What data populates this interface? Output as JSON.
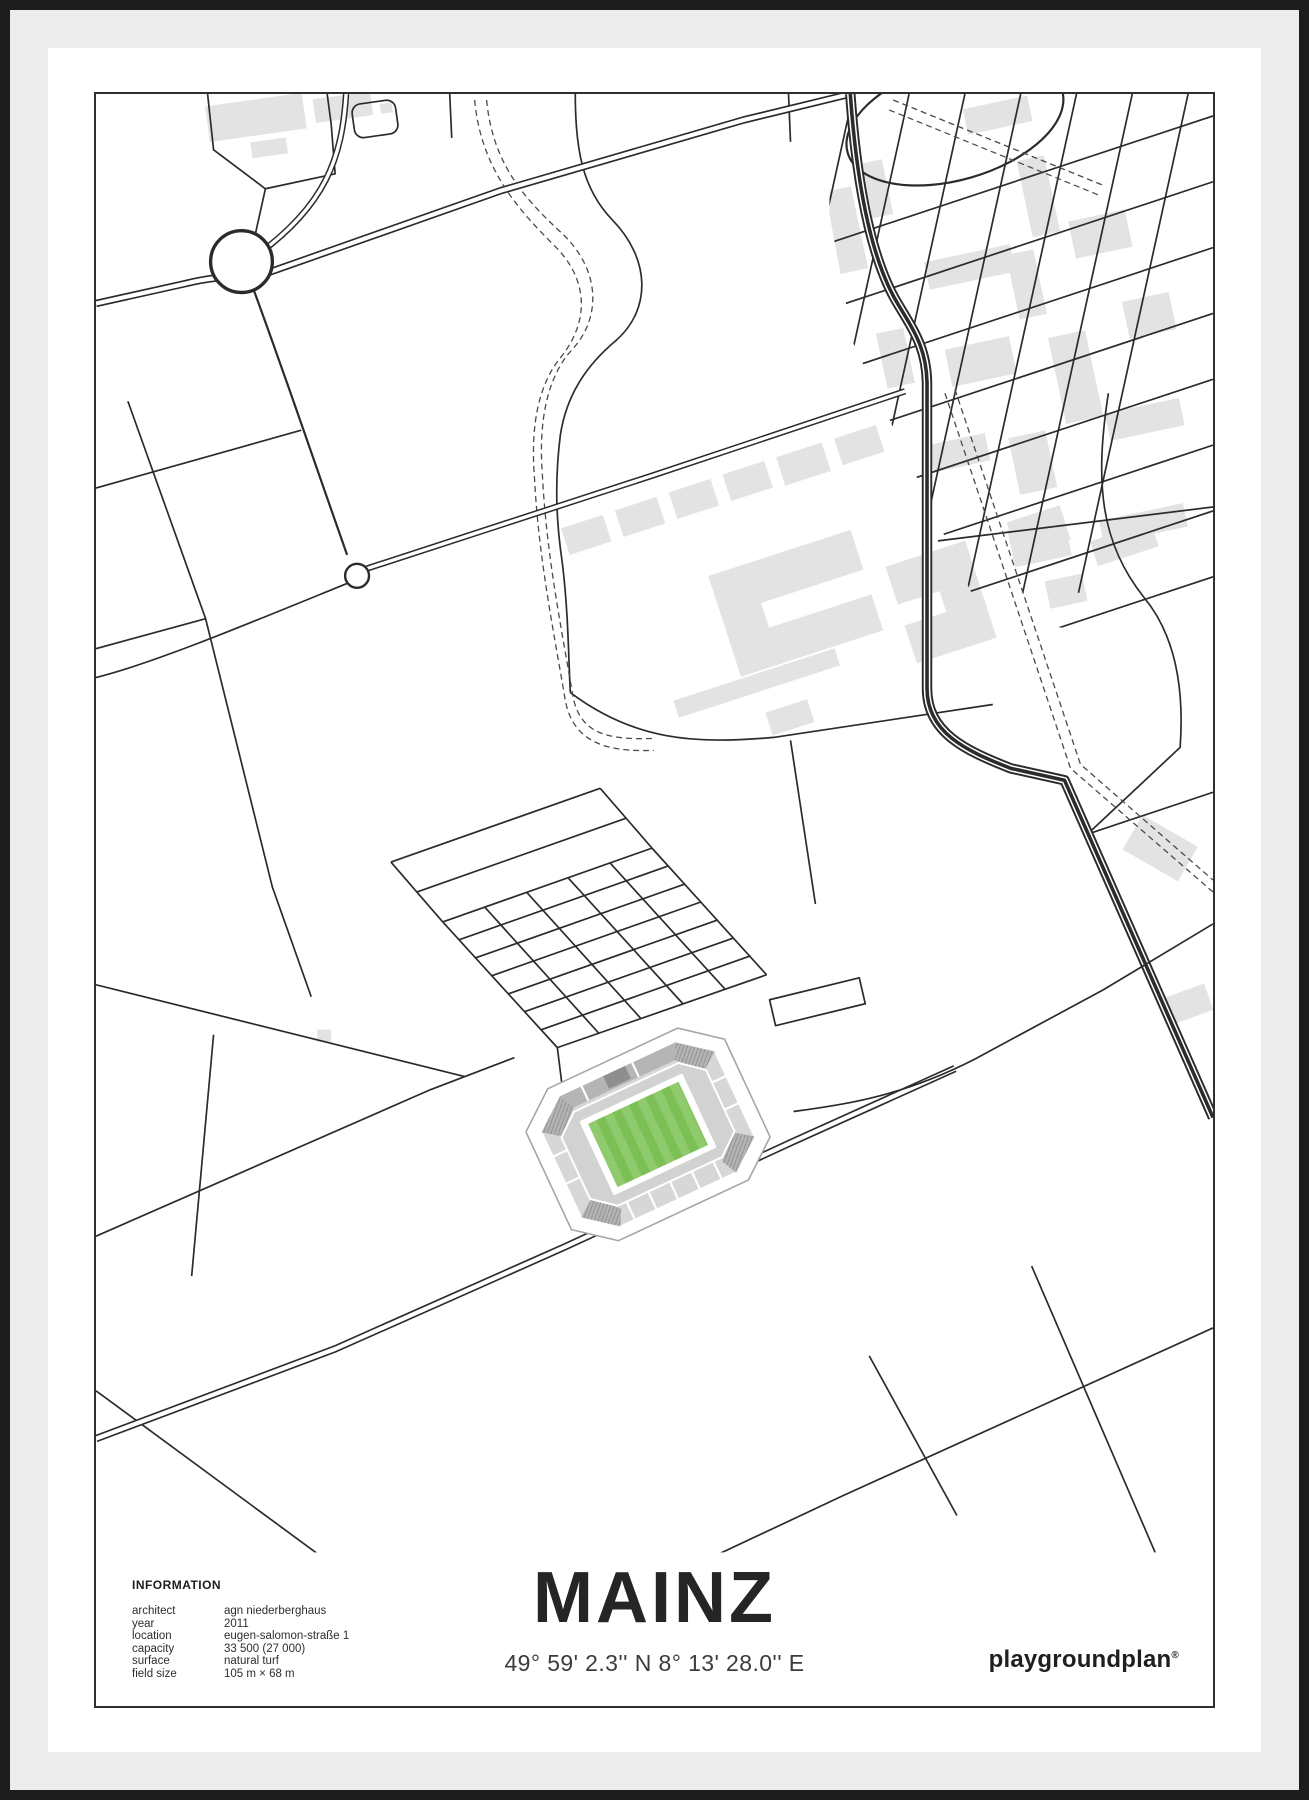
{
  "poster": {
    "title": "MAINZ",
    "coordinates": "49° 59' 2.3'' N  8° 13' 28.0'' E",
    "brand": "playgroundplan",
    "brand_mark": "®",
    "information": {
      "heading": "INFORMATION",
      "rows": [
        {
          "label": "architect",
          "value": "agn niederberghaus"
        },
        {
          "label": "year",
          "value": "2011"
        },
        {
          "label": "location",
          "value": "eugen-salomon-straße 1"
        },
        {
          "label": "capacity",
          "value": "33 500 (27 000)"
        },
        {
          "label": "surface",
          "value": "natural turf"
        },
        {
          "label": "field size",
          "value": "105 m × 68 m"
        }
      ]
    },
    "map": {
      "landmarks": [
        "roundabout",
        "mini-roundabout",
        "motorway",
        "residential-grid",
        "campus-buildings",
        "vineyard-grid",
        "stadium",
        "football-pitch",
        "footpaths"
      ]
    },
    "colors": {
      "road": "#2b2b2b",
      "building": "#e3e3e3",
      "stand": "#d7d7d7",
      "stand_dark": "#b5b5b5",
      "pitch_light": "#8fca6d",
      "pitch_dark": "#7cbf55",
      "mat": "#ececec",
      "frame": "#1c1c1c"
    }
  }
}
